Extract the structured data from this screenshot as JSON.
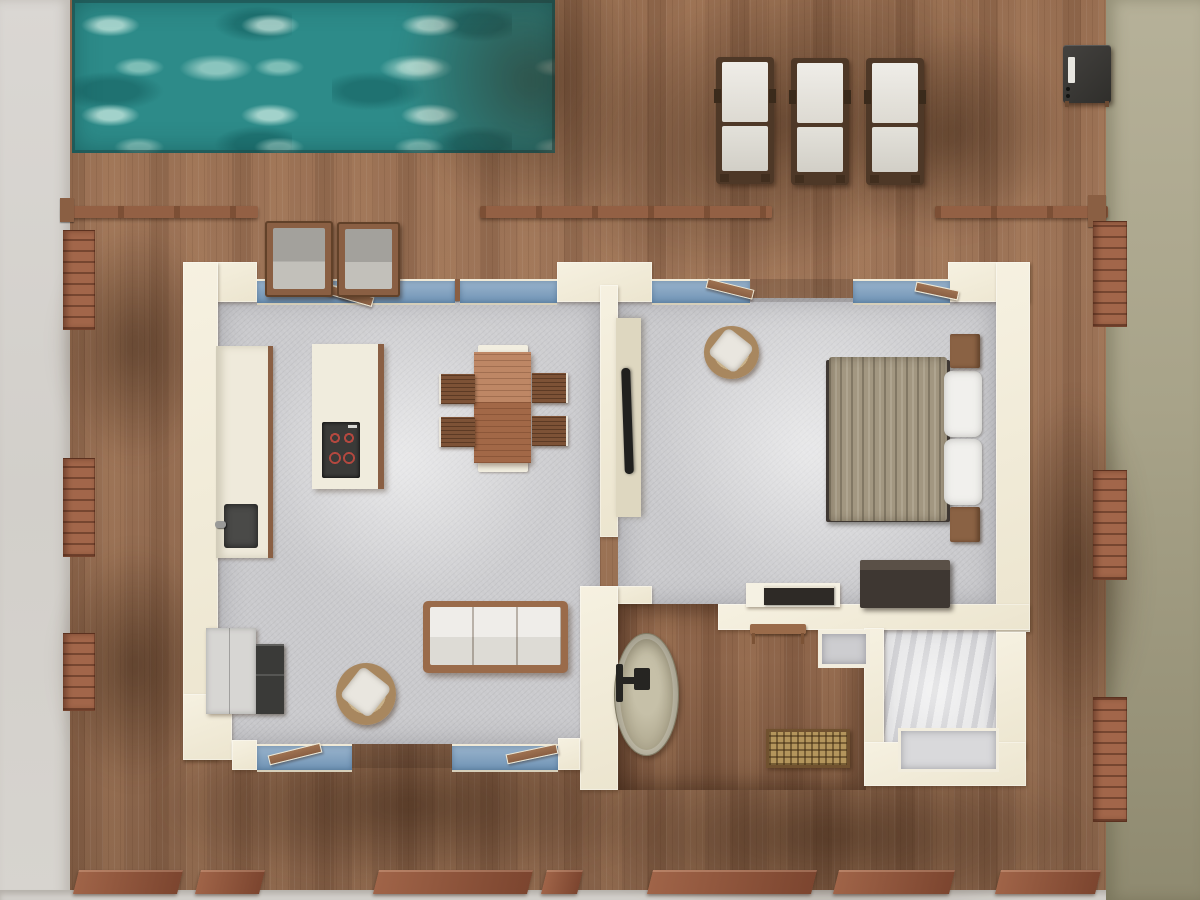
{
  "scene": {
    "description": "Top-down 3D architectural render of a one-bedroom pool villa with a wooden deck, swimming pool, open-plan living/kitchen, bedroom, bathroom and walk-in closet",
    "colors": {
      "ground-left": "#d6d3cf",
      "ground-right": "#b6b199",
      "deck-wood": "#a1775a",
      "deck-edge": "#8a5a3d",
      "pool-water": "#2d8b89",
      "pool-foam": "#cdeade",
      "wall": "#f1ecdb",
      "interior-floor": "#cacacd",
      "closet-floor": "#e9e9ea",
      "glass": "#6f93b5",
      "frame-wood": "#8a5f43",
      "lounger-frame": "#4e3827",
      "cushion-white": "#e9e7e2",
      "cushion-gray": "#a3a19c",
      "sofa-wood": "#9a6b4a",
      "table-wood": "#b0714d",
      "chair-wood": "#7d5236",
      "wicker": "#a8875f",
      "blanket": "#a29781",
      "pillow": "#f1f0ed",
      "nightstand": "#8a6244",
      "dresser": "#3e3732",
      "bedframe": "#3f3833",
      "appliance-dark": "#3a3a38",
      "appliance-light": "#d7d6d3",
      "burner-red": "#b4483f",
      "sink-dark": "#4a4a48",
      "tub-stone": "#b2ab92",
      "faucet-dark": "#262522",
      "rattan": "#b3955c",
      "media-panel": "#ded7c0",
      "tv": "#20201e",
      "desk-white": "#f5f1e3",
      "book-dark": "#2e2a26"
    },
    "rooms": [
      {
        "name": "swimming-pool"
      },
      {
        "name": "wooden-deck"
      },
      {
        "name": "surrounding-ground"
      },
      {
        "name": "living-room"
      },
      {
        "name": "kitchen"
      },
      {
        "name": "dining-area"
      },
      {
        "name": "hallway"
      },
      {
        "name": "bedroom"
      },
      {
        "name": "bathroom"
      },
      {
        "name": "walk-in-closet"
      }
    ],
    "furniture": [
      {
        "name": "sun-lounger",
        "count": 3
      },
      {
        "name": "outdoor-armchair",
        "count": 2
      },
      {
        "name": "barbecue-grill",
        "count": 1
      },
      {
        "name": "kitchen-counter-with-sink",
        "count": 1
      },
      {
        "name": "fridge-and-oven",
        "count": 1
      },
      {
        "name": "kitchen-island-cooktop",
        "count": 1
      },
      {
        "name": "dining-table",
        "count": 1
      },
      {
        "name": "dining-chair",
        "count": 4
      },
      {
        "name": "dining-bench",
        "count": 2
      },
      {
        "name": "sofa",
        "count": 1
      },
      {
        "name": "round-wicker-chair",
        "count": 2
      },
      {
        "name": "media-wall-tv",
        "count": 1
      },
      {
        "name": "double-bed",
        "count": 1
      },
      {
        "name": "nightstand",
        "count": 2
      },
      {
        "name": "dresser-chest",
        "count": 1
      },
      {
        "name": "desk-with-books",
        "count": 1
      },
      {
        "name": "desk-bench",
        "count": 1
      },
      {
        "name": "freestanding-bathtub",
        "count": 1
      },
      {
        "name": "rattan-bench",
        "count": 1
      },
      {
        "name": "closet-doorway",
        "count": 1
      }
    ]
  }
}
